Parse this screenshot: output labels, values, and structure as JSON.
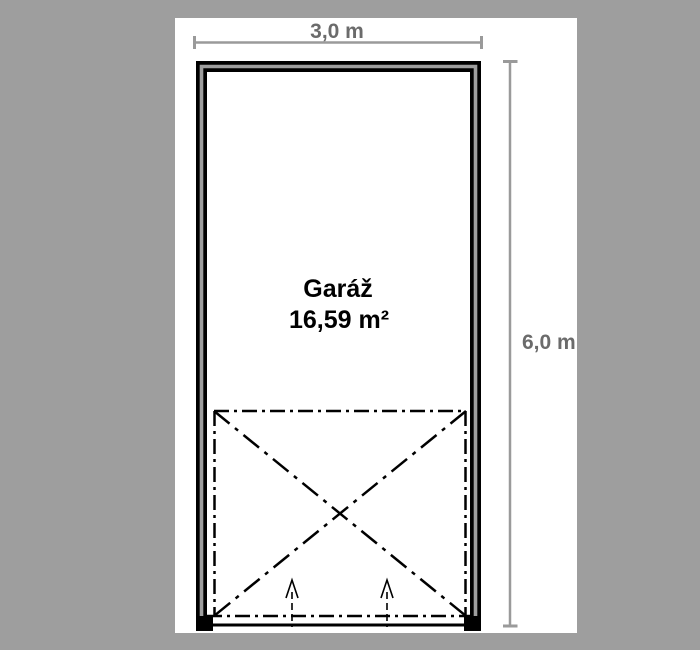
{
  "page": {
    "background_color": "#9e9e9e",
    "canvas_color": "#ffffff"
  },
  "plan": {
    "room": {
      "name": "Garáž",
      "area": "16,59 m²"
    },
    "dimensions": {
      "width": {
        "label": "3,0 m"
      },
      "height": {
        "label": "6,0 m"
      }
    },
    "colors": {
      "wall_black": "#000000",
      "wall_core_gray": "#9e9e9e",
      "dimension_line": "#9a9a9a",
      "dimension_text": "#6b6b6b",
      "room_text": "#000000",
      "door_area_line": "#000000"
    },
    "icons": {
      "entrance_arrow": "up-arrow"
    }
  }
}
